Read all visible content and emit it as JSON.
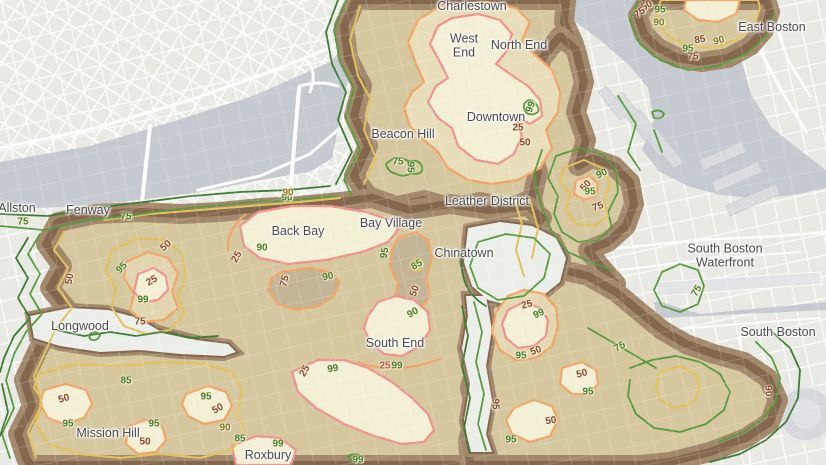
{
  "map": {
    "title": "Boston percentile contour map",
    "contour_levels": [
      25,
      50,
      75,
      85,
      90,
      95,
      99
    ],
    "palette": {
      "w": "#8c4a2e",
      "r": "#bf5a48",
      "g": "#4a7d28",
      "o": "#7d7d26",
      "a": "#9b7b2b",
      "line_25": "#f2928d",
      "line_50": "#f2a566",
      "line_75": "#e2c25c",
      "line_green": "#589b3e",
      "line_dark_green": "#3e7c35",
      "fill_core": "#f4f0d6",
      "fill_band": "#d5c79e",
      "rim_light": "#a3896b",
      "rim_dark": "#84684e",
      "water": "#c5cad0",
      "land": "#e9eae4"
    },
    "neighborhoods": [
      {
        "label": "Charlestown",
        "x": 472,
        "y": 7
      },
      {
        "label": "West\nEnd",
        "x": 464,
        "y": 46
      },
      {
        "label": "North End",
        "x": 519,
        "y": 46
      },
      {
        "label": "East Boston",
        "x": 772,
        "y": 28
      },
      {
        "label": "Downtown",
        "x": 496,
        "y": 118
      },
      {
        "label": "Beacon Hill",
        "x": 403,
        "y": 135
      },
      {
        "label": "Leather District",
        "x": 487,
        "y": 202
      },
      {
        "label": "Allston",
        "x": 17,
        "y": 209
      },
      {
        "label": "Fenway",
        "x": 88,
        "y": 211
      },
      {
        "label": "Bay Village",
        "x": 391,
        "y": 224
      },
      {
        "label": "Back Bay",
        "x": 298,
        "y": 232
      },
      {
        "label": "Chinatown",
        "x": 464,
        "y": 254
      },
      {
        "label": "South Boston\nWaterfront",
        "x": 725,
        "y": 256
      },
      {
        "label": "Longwood",
        "x": 80,
        "y": 327
      },
      {
        "label": "South Boston",
        "x": 778,
        "y": 333
      },
      {
        "label": "South End",
        "x": 395,
        "y": 344
      },
      {
        "label": "Mission Hill",
        "x": 108,
        "y": 434
      },
      {
        "label": "Roxbury",
        "x": 268,
        "y": 456
      }
    ],
    "contour_labels": [
      {
        "v": "25",
        "x": 518,
        "y": 128,
        "rot": 0,
        "c": "w"
      },
      {
        "v": "50",
        "x": 525,
        "y": 143,
        "rot": 0,
        "c": "w"
      },
      {
        "v": "99",
        "x": 531,
        "y": 107,
        "rot": -70,
        "c": "g"
      },
      {
        "v": "90",
        "x": 287,
        "y": 198,
        "rot": 0,
        "c": "g"
      },
      {
        "v": "90",
        "x": 288,
        "y": 193,
        "rot": 0,
        "c": "a"
      },
      {
        "v": "90",
        "x": 262,
        "y": 248,
        "rot": 0,
        "c": "g"
      },
      {
        "v": "25",
        "x": 237,
        "y": 257,
        "rot": -60,
        "c": "w"
      },
      {
        "v": "75",
        "x": 285,
        "y": 281,
        "rot": -75,
        "c": "w"
      },
      {
        "v": "90",
        "x": 328,
        "y": 277,
        "rot": -10,
        "c": "g"
      },
      {
        "v": "95",
        "x": 385,
        "y": 253,
        "rot": -80,
        "c": "g"
      },
      {
        "v": "85",
        "x": 417,
        "y": 265,
        "rot": -30,
        "c": "g"
      },
      {
        "v": "50",
        "x": 415,
        "y": 291,
        "rot": -70,
        "c": "w"
      },
      {
        "v": "90",
        "x": 413,
        "y": 313,
        "rot": -30,
        "c": "g"
      },
      {
        "v": "75",
        "x": 23,
        "y": 222,
        "rot": 0,
        "c": "g"
      },
      {
        "v": "75",
        "x": 126,
        "y": 217,
        "rot": 0,
        "c": "g"
      },
      {
        "v": "50",
        "x": 70,
        "y": 279,
        "rot": -80,
        "c": "w"
      },
      {
        "v": "95",
        "x": 122,
        "y": 268,
        "rot": -45,
        "c": "g"
      },
      {
        "v": "50",
        "x": 166,
        "y": 246,
        "rot": -40,
        "c": "w"
      },
      {
        "v": "25",
        "x": 152,
        "y": 281,
        "rot": -30,
        "c": "w"
      },
      {
        "v": "99",
        "x": 143,
        "y": 300,
        "rot": 0,
        "c": "g"
      },
      {
        "v": "75",
        "x": 140,
        "y": 322,
        "rot": 0,
        "c": "w"
      },
      {
        "v": "75",
        "x": 398,
        "y": 162,
        "rot": 0,
        "c": "g"
      },
      {
        "v": "95",
        "x": 410,
        "y": 167,
        "rot": 90,
        "c": "g"
      },
      {
        "v": "25",
        "x": 305,
        "y": 371,
        "rot": -60,
        "c": "w"
      },
      {
        "v": "99",
        "x": 333,
        "y": 369,
        "rot": -10,
        "c": "g"
      },
      {
        "v": "25",
        "x": 385,
        "y": 366,
        "rot": 0,
        "c": "r"
      },
      {
        "v": "99",
        "x": 397,
        "y": 366,
        "rot": 0,
        "c": "g"
      },
      {
        "v": "99",
        "x": 358,
        "y": 460,
        "rot": 0,
        "c": "g"
      },
      {
        "v": "99",
        "x": 278,
        "y": 444,
        "rot": 0,
        "c": "g"
      },
      {
        "v": "85",
        "x": 240,
        "y": 439,
        "rot": 0,
        "c": "g"
      },
      {
        "v": "90",
        "x": 225,
        "y": 428,
        "rot": 0,
        "c": "o"
      },
      {
        "v": "85",
        "x": 126,
        "y": 381,
        "rot": 0,
        "c": "g"
      },
      {
        "v": "50",
        "x": 64,
        "y": 399,
        "rot": -15,
        "c": "w"
      },
      {
        "v": "95",
        "x": 68,
        "y": 424,
        "rot": 0,
        "c": "g"
      },
      {
        "v": "95",
        "x": 154,
        "y": 424,
        "rot": 0,
        "c": "g"
      },
      {
        "v": "50",
        "x": 145,
        "y": 442,
        "rot": 0,
        "c": "w"
      },
      {
        "v": "95",
        "x": 206,
        "y": 397,
        "rot": 0,
        "c": "g"
      },
      {
        "v": "50",
        "x": 218,
        "y": 409,
        "rot": -30,
        "c": "w"
      },
      {
        "v": "25",
        "x": 527,
        "y": 305,
        "rot": -15,
        "c": "w"
      },
      {
        "v": "99",
        "x": 539,
        "y": 314,
        "rot": -25,
        "c": "g"
      },
      {
        "v": "50",
        "x": 536,
        "y": 351,
        "rot": -20,
        "c": "w"
      },
      {
        "v": "95",
        "x": 521,
        "y": 356,
        "rot": 0,
        "c": "g"
      },
      {
        "v": "50",
        "x": 582,
        "y": 374,
        "rot": -15,
        "c": "w"
      },
      {
        "v": "95",
        "x": 588,
        "y": 392,
        "rot": 0,
        "c": "g"
      },
      {
        "v": "50",
        "x": 551,
        "y": 421,
        "rot": -10,
        "c": "w"
      },
      {
        "v": "95",
        "x": 511,
        "y": 440,
        "rot": 0,
        "c": "g"
      },
      {
        "v": "95",
        "x": 495,
        "y": 404,
        "rot": 90,
        "c": "w"
      },
      {
        "v": "75",
        "x": 620,
        "y": 347,
        "rot": -30,
        "c": "g"
      },
      {
        "v": "75",
        "x": 697,
        "y": 291,
        "rot": -60,
        "c": "g"
      },
      {
        "v": "90",
        "x": 768,
        "y": 391,
        "rot": 85,
        "c": "w"
      },
      {
        "v": "50",
        "x": 586,
        "y": 186,
        "rot": -45,
        "c": "w"
      },
      {
        "v": "95",
        "x": 590,
        "y": 192,
        "rot": 0,
        "c": "g"
      },
      {
        "v": "75",
        "x": 598,
        "y": 207,
        "rot": -20,
        "c": "w"
      },
      {
        "v": "90",
        "x": 602,
        "y": 174,
        "rot": -25,
        "c": "g"
      },
      {
        "v": "50",
        "x": 647,
        "y": 6,
        "rot": -30,
        "c": "w"
      },
      {
        "v": "95",
        "x": 660,
        "y": 10,
        "rot": 0,
        "c": "g"
      },
      {
        "v": "75",
        "x": 640,
        "y": 13,
        "rot": -35,
        "c": "w"
      },
      {
        "v": "90",
        "x": 659,
        "y": 23,
        "rot": 0,
        "c": "o"
      },
      {
        "v": "85",
        "x": 700,
        "y": 40,
        "rot": -10,
        "c": "w"
      },
      {
        "v": "90",
        "x": 719,
        "y": 41,
        "rot": -15,
        "c": "o"
      },
      {
        "v": "95",
        "x": 688,
        "y": 49,
        "rot": 0,
        "c": "g"
      },
      {
        "v": "75",
        "x": 693,
        "y": 57,
        "rot": 0,
        "c": "w"
      }
    ]
  }
}
